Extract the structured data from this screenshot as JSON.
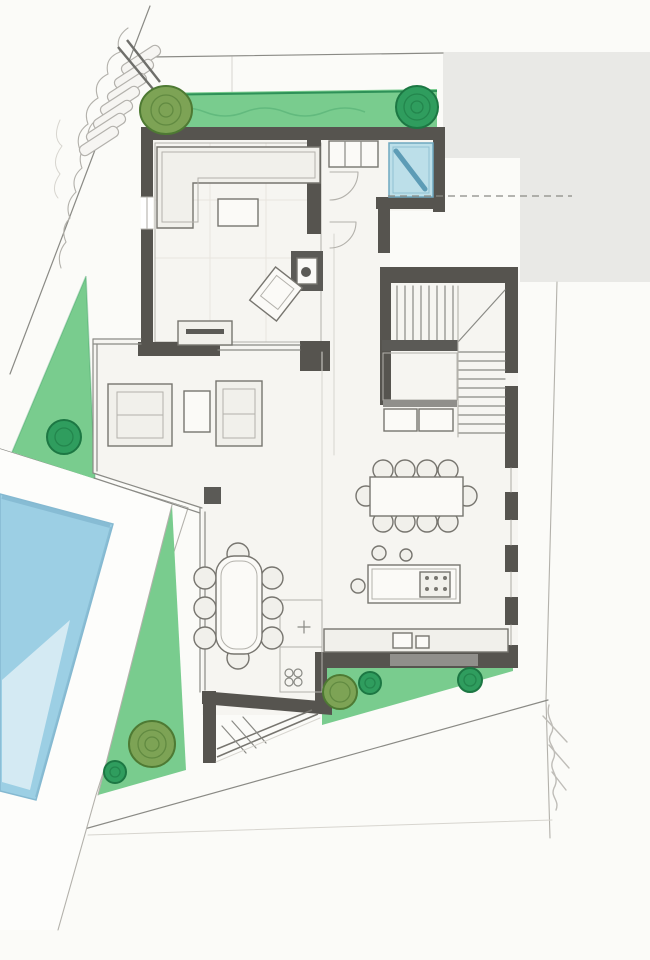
{
  "canvas": {
    "width": 650,
    "height": 960
  },
  "palette": {
    "paper": "#fbfbf8",
    "floor": "#f6f5f1",
    "deck": "#fdfdfb",
    "block": "#e9e9e6",
    "wall": "#56544f",
    "dark_fill": "#5b5a56",
    "mid_fill": "#908f8b",
    "pencil": "#8a8a85",
    "pencil_light": "#b3b1ab",
    "pencil_xlight": "#d7d5cf",
    "tile_line": "#e8e5de",
    "furniture_line": "#77756f",
    "furniture_fill": "#f1f0eb",
    "furniture_white": "#fbfaf7",
    "grass": "#79cc8e",
    "grass_light": "#a0dcab",
    "grass_line": "#2e9158",
    "bush_olive": "#7da355",
    "bush_olive_line": "#4e7a33",
    "bush_dark": "#2f9d5e",
    "bush_dark_line": "#1c7743",
    "pool_top": "#9ccfe4",
    "pool_bottom": "#e7f3f8",
    "pool_line": "#85b9d1",
    "glass": "#bcdfe9",
    "glass_line": "#6fa8c0",
    "glass_diag": "#5d9cb6",
    "signature": "#bfbdb8"
  },
  "features": [
    "hand-drawn ground floor plan",
    "garden strip with trees",
    "swimming pool with deck",
    "entry vestibule with blue glazing",
    "corner sofa and coffee table",
    "fireplace",
    "armchair lounge",
    "u-shaped staircase",
    "dining table with ten chairs",
    "kitchen island with cooktop and stools",
    "kitchen counter with sink",
    "pantry",
    "oval terrace table with eight chairs",
    "entrance ramp with hatching",
    "plot boundary lines",
    "neighbor block",
    "architect signature"
  ]
}
